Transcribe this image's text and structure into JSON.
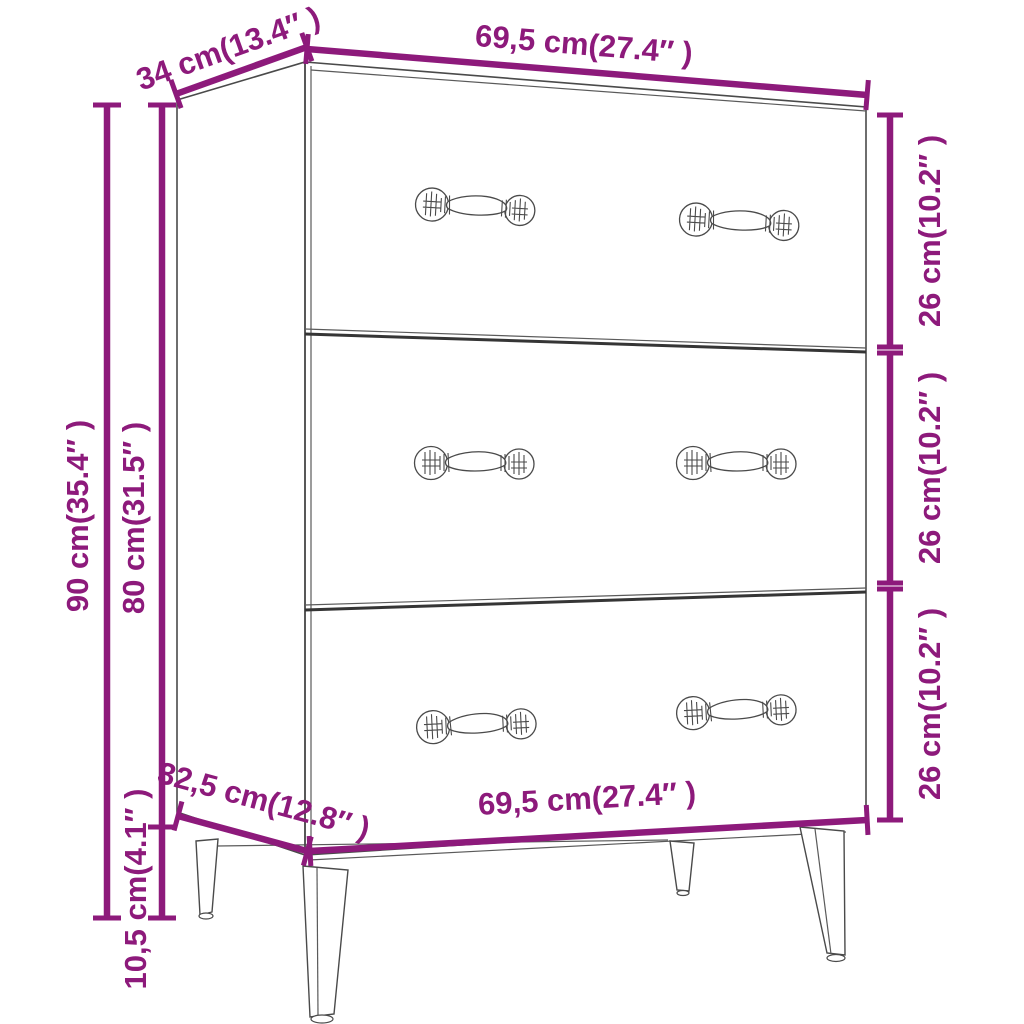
{
  "figure": {
    "subject": "three-drawer sideboard on tall legs, line drawing with dimension annotations",
    "accent_color": "#8D1A7B",
    "outline_color": "#4A4A4A",
    "background": "#FFFFFF"
  },
  "labels": {
    "top_depth": "34 cm(13.4″ )",
    "top_width": "69,5 cm(27.4″ )",
    "overall_height": "90 cm(35.4″ )",
    "body_height": "80 cm(31.5″ )",
    "drawer_heights": [
      "26 cm(10.2″ )",
      "26 cm(10.2″ )",
      "26 cm(10.2″ )"
    ],
    "bottom_depth": "32,5 cm(12.8″ )",
    "bottom_width": "69,5 cm(27.4″ )",
    "leg_height": "10,5 cm(4.1″ )"
  }
}
